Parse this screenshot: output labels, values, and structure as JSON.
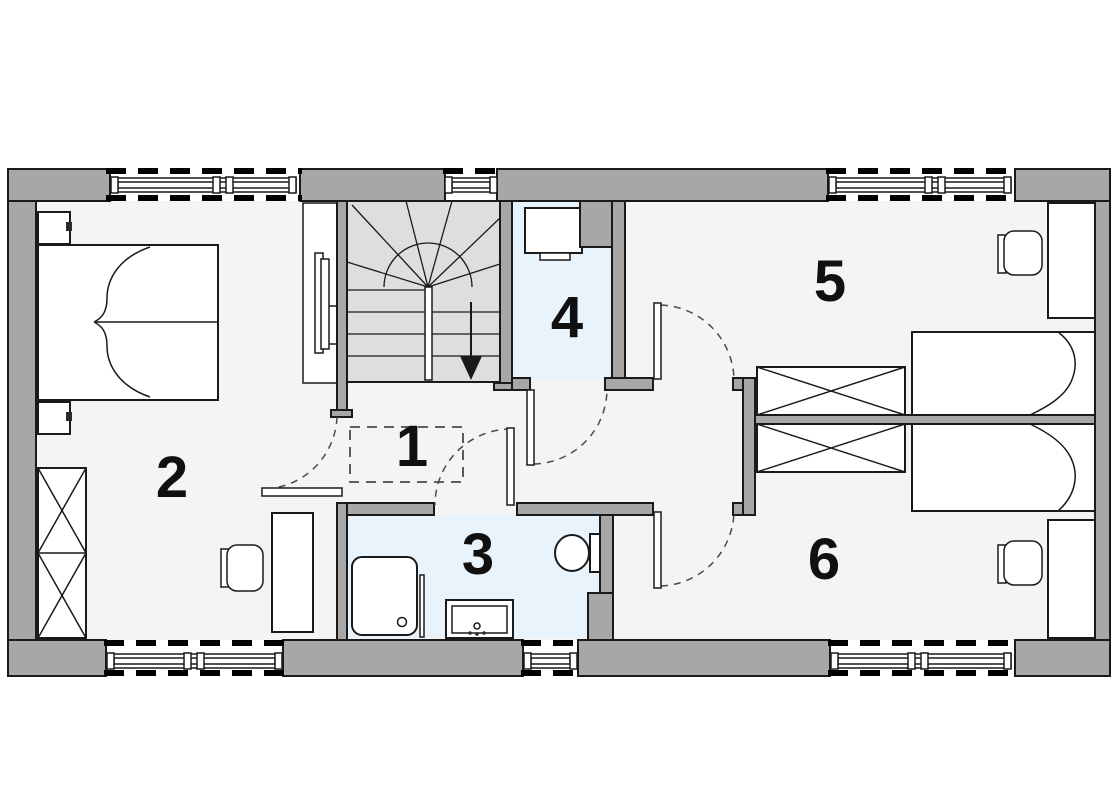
{
  "colors": {
    "wall": "#a7a7a7",
    "floor": "#f3f4f3",
    "wet": "#e8f3fb",
    "stairs": "#dedede",
    "outline": "#1a1a1a",
    "arc": "#4a4a4a",
    "label": "#101010"
  },
  "rooms": [
    {
      "label": "1",
      "name": "hallway"
    },
    {
      "label": "2",
      "name": "bedroom-left"
    },
    {
      "label": "3",
      "name": "bathroom"
    },
    {
      "label": "4",
      "name": "utility-room"
    },
    {
      "label": "5",
      "name": "bedroom-top-right"
    },
    {
      "label": "6",
      "name": "bedroom-bottom-right"
    }
  ],
  "icons": [
    "double-bed",
    "single-bed",
    "nightstand",
    "wardrobe",
    "desk",
    "chair",
    "tv",
    "shower",
    "washbasin",
    "toilet",
    "washing-machine",
    "winder-staircase",
    "window",
    "door-swing",
    "down-arrow"
  ]
}
